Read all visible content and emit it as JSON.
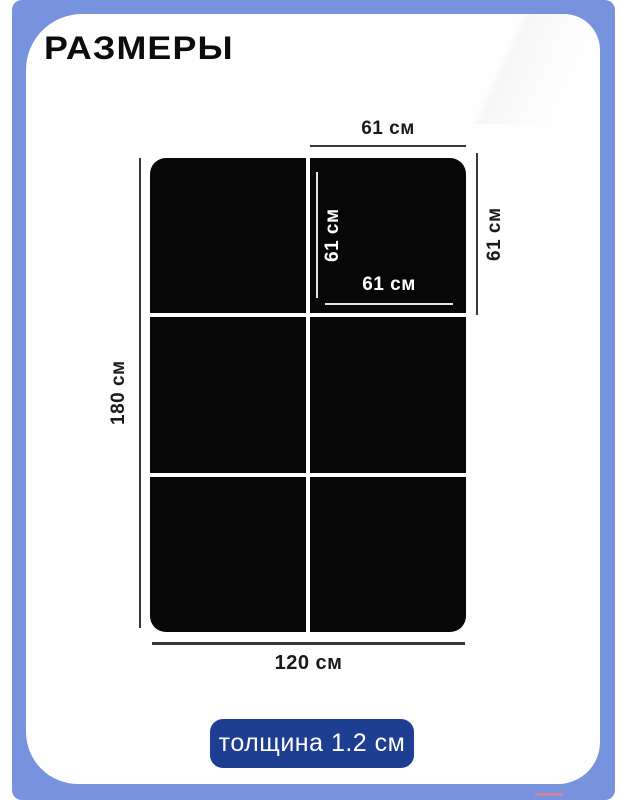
{
  "colors": {
    "frame": "#7793de",
    "card": "#fefefe",
    "tile": "#070707",
    "dim_line": "#383838",
    "inner_line": "#e4e4e4",
    "badge_bg": "#1e3e92",
    "badge_text": "#ffffff",
    "text": "#1a1a1a"
  },
  "title": "РАЗМЕРЫ",
  "diagram": {
    "grid": {
      "rows": 3,
      "cols": 2
    },
    "labels": {
      "tile_width_top": "61 см",
      "tile_height_right": "61 см",
      "tile_height_inner": "61 см",
      "tile_width_inner": "61 см",
      "total_height_left": "180 см",
      "total_width_bottom": "120 см"
    }
  },
  "badge": {
    "label": "толщина 1.2 см"
  }
}
